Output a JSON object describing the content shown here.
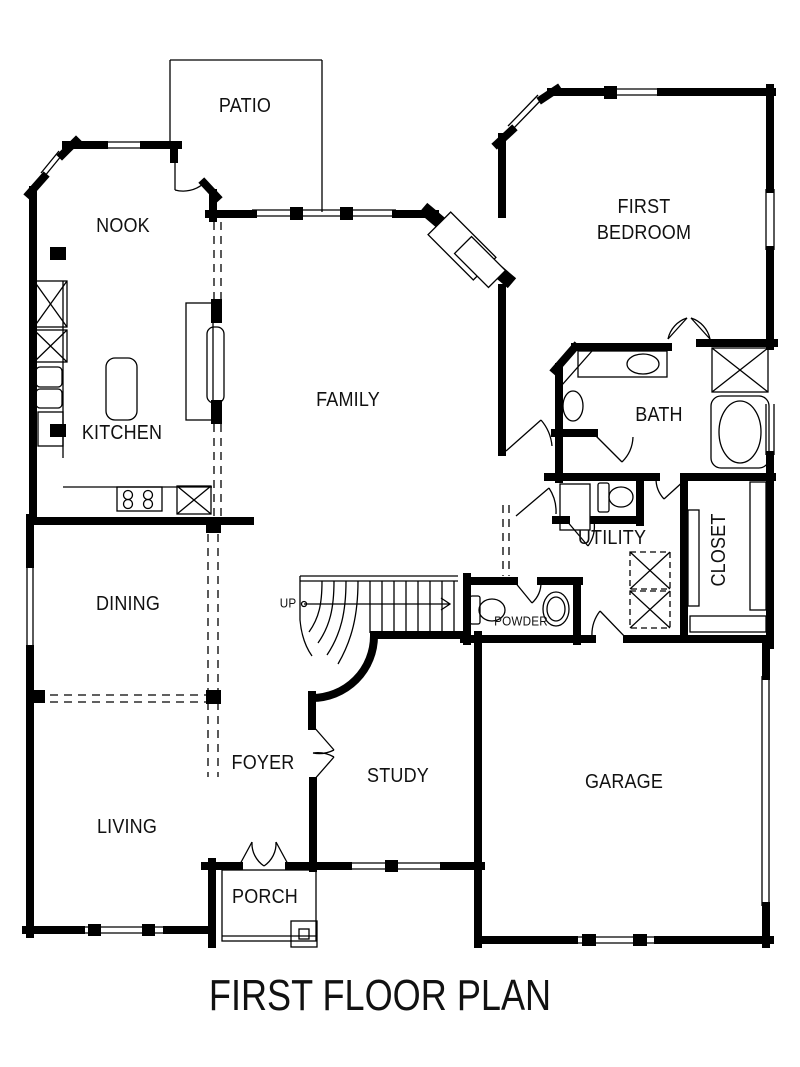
{
  "plan_title": "FIRST FLOOR PLAN",
  "colors": {
    "ink": "#000000",
    "paper": "#ffffff"
  },
  "rooms": [
    {
      "id": "patio",
      "label": "PATIO"
    },
    {
      "id": "nook",
      "label": "NOOK"
    },
    {
      "id": "first-bedroom",
      "label": "FIRST\nBEDROOM"
    },
    {
      "id": "kitchen",
      "label": "KITCHEN"
    },
    {
      "id": "family",
      "label": "FAMILY"
    },
    {
      "id": "bath",
      "label": "BATH"
    },
    {
      "id": "utility",
      "label": "UTILITY"
    },
    {
      "id": "closet",
      "label": "CLOSET"
    },
    {
      "id": "dining",
      "label": "DINING"
    },
    {
      "id": "powder",
      "label": "POWDER"
    },
    {
      "id": "foyer",
      "label": "FOYER"
    },
    {
      "id": "study",
      "label": "STUDY"
    },
    {
      "id": "garage",
      "label": "GARAGE"
    },
    {
      "id": "living",
      "label": "LIVING"
    },
    {
      "id": "porch",
      "label": "PORCH"
    }
  ],
  "annotations": {
    "stair_direction": "UP"
  }
}
